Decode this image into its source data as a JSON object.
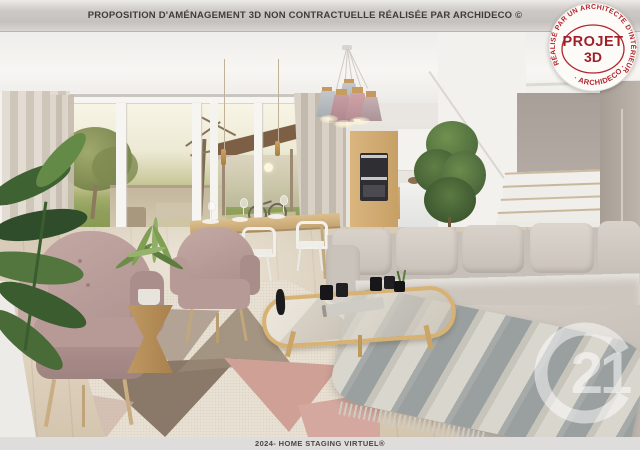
{
  "header": {
    "banner": "PROPOSITION D'AMÉNAGEMENT 3D NON CONTRACTUELLE RÉALISÉE PAR ARCHIDECO ©"
  },
  "footer": {
    "banner": "2024- HOME STAGING VIRTUEL®"
  },
  "stamp": {
    "arc_top": "RÉALISÉ PAR UN ARCHITECTE D'INTÉRIEUR",
    "arc_bottom": "· ARCHIDECO ·",
    "title_line1": "PROJET",
    "title_line2": "3D",
    "ink_color": "#a8232e"
  },
  "watermark": {
    "icon": "c21-logo",
    "label": "21"
  },
  "scene": {
    "subject": "3D staged open-plan living room render",
    "palette": {
      "wall_taupe": "#aca39b",
      "sofa_gray": "#cdc7bf",
      "armchair_mauve": "#b79a96",
      "rug_pink": "#cfa096",
      "rug_brown": "#8a7868",
      "wood_oak": "#d2ab74",
      "plant_green": "#4d6b3a",
      "floor_wood": "#d8cbb7"
    }
  }
}
